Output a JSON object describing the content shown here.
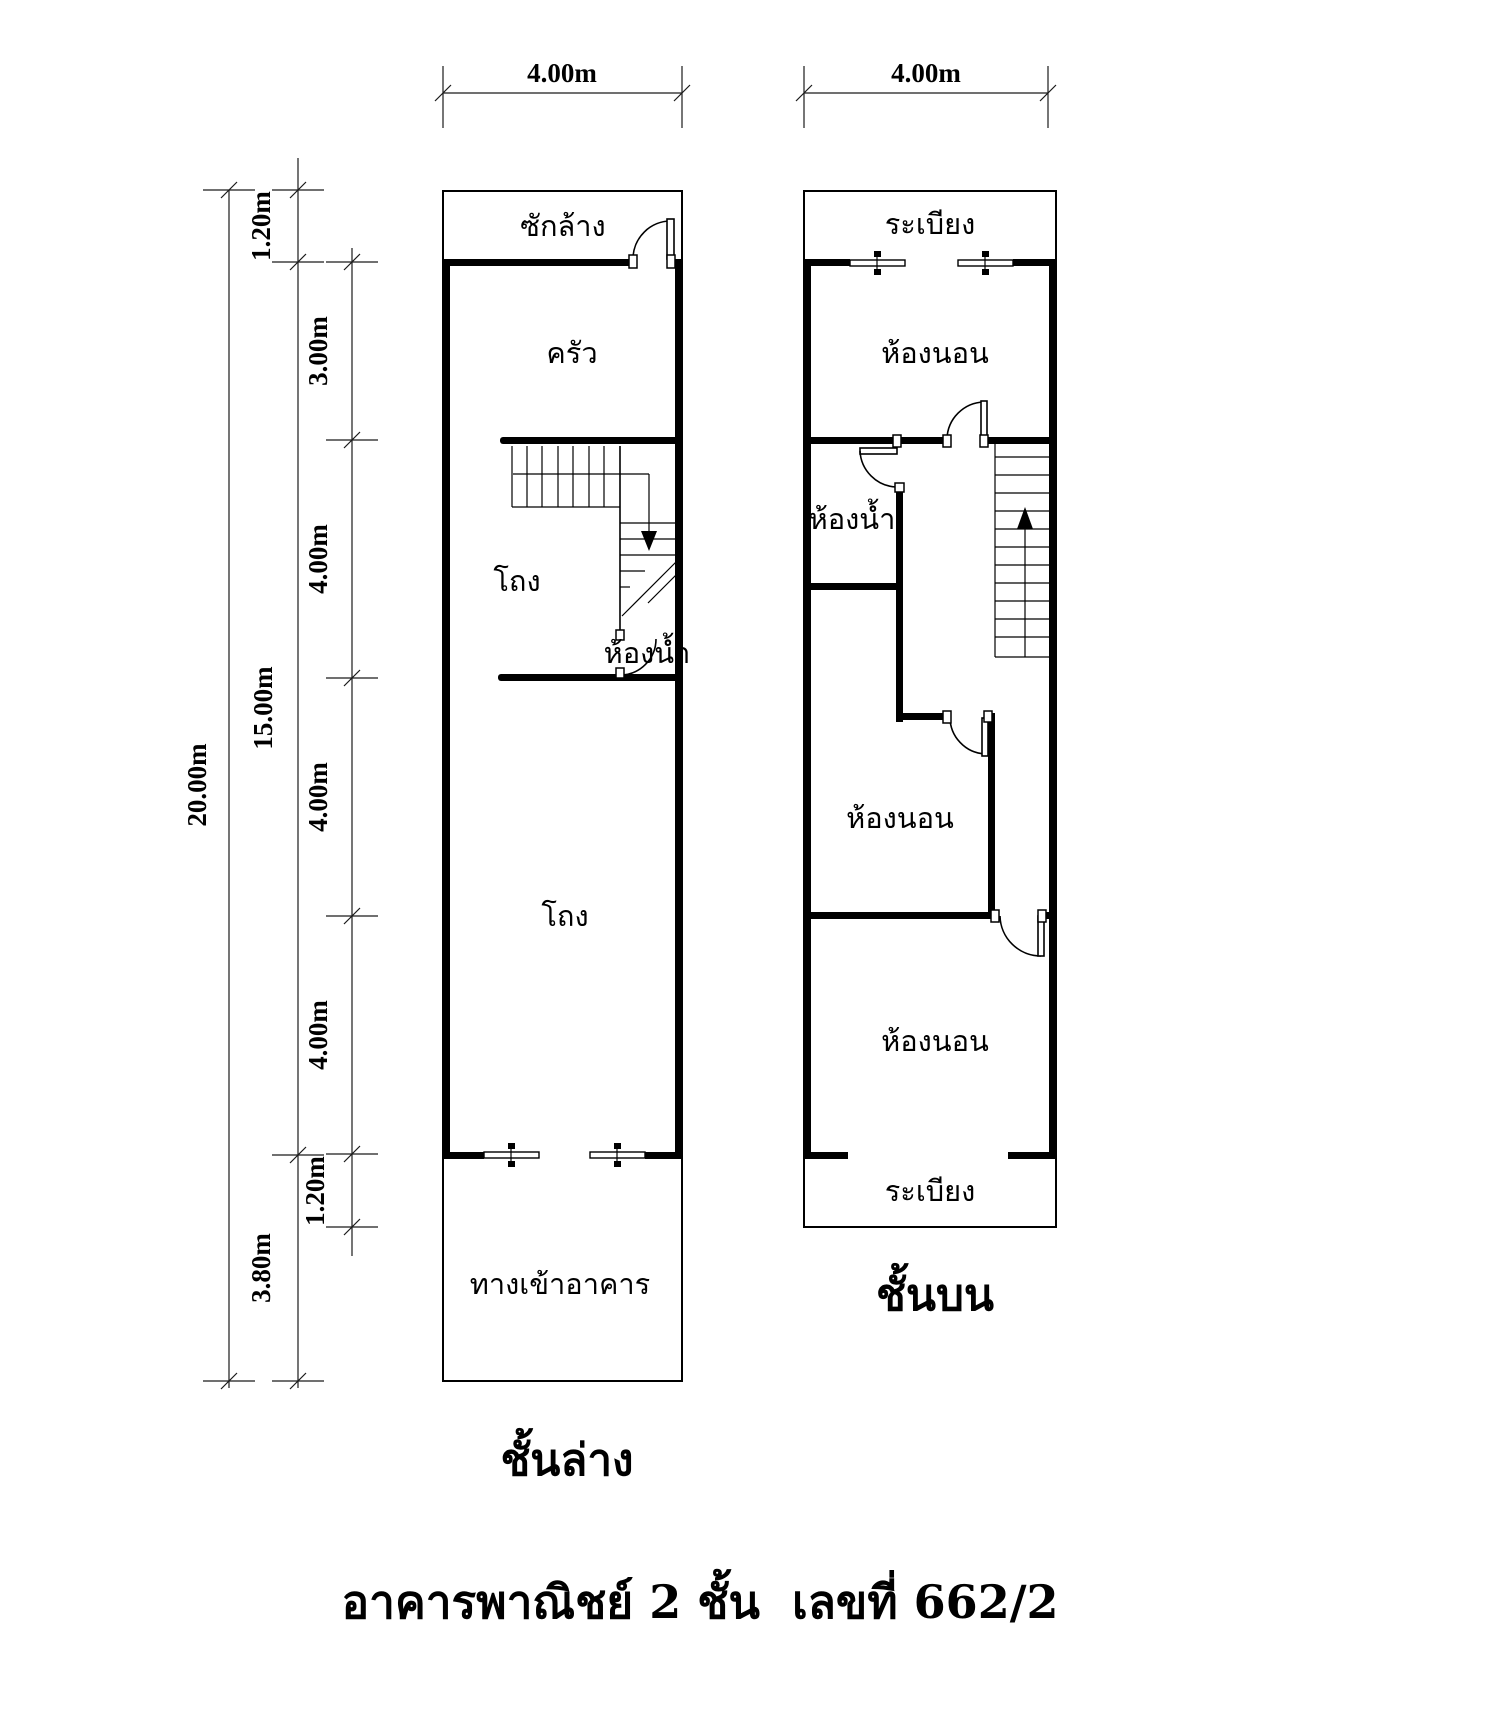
{
  "main_title": "อาคารพาณิชย์ 2 ชั้น  เลขที่ 662/2",
  "dims": {
    "top_left_width": "4.00m",
    "top_right_width": "4.00m",
    "total_height": "20.00m",
    "main_height": "15.00m",
    "seg_back_balcony": "1.20m",
    "seg_kitchen": "3.00m",
    "seg_a": "4.00m",
    "seg_b": "4.00m",
    "seg_c": "4.00m",
    "seg_front_balcony": "1.20m",
    "seg_entrance": "3.80m"
  },
  "ground_floor": {
    "title": "ชั้นล่าง",
    "rooms": {
      "laundry": "ซักล้าง",
      "kitchen": "ครัว",
      "hall_upper": "โถง",
      "bathroom": "ห้องน้ำ",
      "hall_lower": "โถง",
      "entrance": "ทางเข้าอาคาร"
    }
  },
  "upper_floor": {
    "title": "ชั้นบน",
    "rooms": {
      "balcony_top": "ระเบียง",
      "bedroom_top": "ห้องนอน",
      "bathroom": "ห้องน้ำ",
      "bedroom_middle": "ห้องนอน",
      "bedroom_bottom": "ห้องนอน",
      "balcony_bottom": "ระเบียง"
    }
  }
}
